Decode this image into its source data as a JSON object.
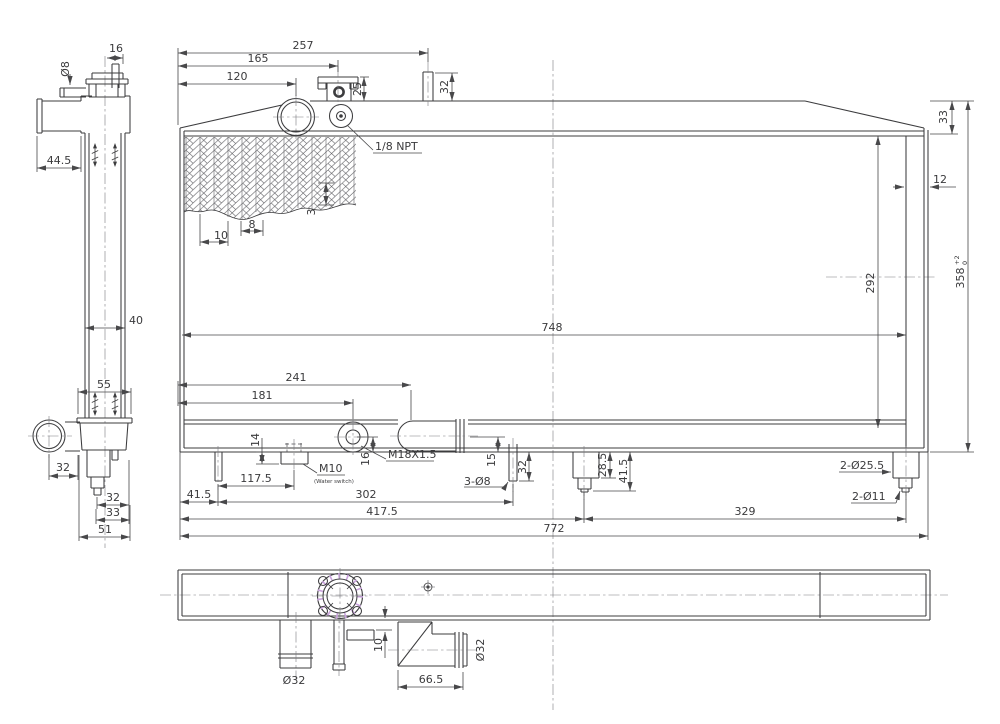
{
  "drawing": {
    "subject": "radiator-technical-drawing",
    "colors": {
      "line": "#3c3c3e",
      "accent": "#c9a2dd",
      "background": "#ffffff"
    },
    "side_view": {
      "d16": "16",
      "dia8": "Ø8",
      "d44_5": "44.5",
      "d40": "40",
      "d55": "55",
      "d32_hose": "32",
      "d32_step": "32",
      "d33": "33",
      "d51": "51"
    },
    "front_view": {
      "d257": "257",
      "d165": "165",
      "d120": "120",
      "d25": "25",
      "d32_pipe": "32",
      "npt": "1/8 NPT",
      "d33": "33",
      "d12": "12",
      "d292": "292",
      "d358": "358",
      "tol_up": "+2",
      "tol_dn": "0",
      "d748": "748",
      "d3": "3",
      "d8": "8",
      "d10": "10",
      "d241": "241",
      "d181": "181",
      "d14": "14",
      "d16": "16",
      "m10": "M10",
      "m10_note": "(Water switch)",
      "m18": "M18X1.5",
      "d117_5": "117.5",
      "d41_5": "41.5",
      "d302": "302",
      "d417_5": "417.5",
      "d329": "329",
      "d772": "772",
      "d15": "15",
      "d32_pin": "32",
      "dia8_3": "3-Ø8",
      "d28_5": "28.5",
      "d41_5b": "41.5",
      "dia25_5": "2-Ø25.5",
      "dia11": "2-Ø11"
    },
    "top_view": {
      "dia32_left": "Ø32",
      "d10": "10",
      "d66_5": "66.5",
      "dia32_right": "Ø32"
    }
  }
}
